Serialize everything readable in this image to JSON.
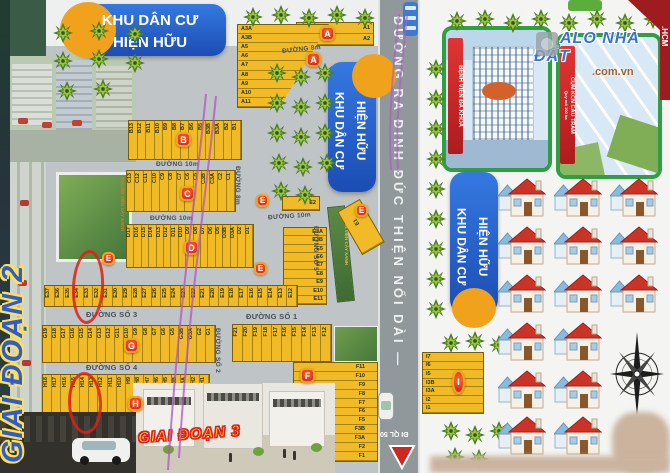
{
  "banners": {
    "residential": {
      "line1": "KHU DÂN CƯ",
      "line2": "HIỆN HỮU"
    },
    "phase2": "GIAI ĐOẠN 2",
    "phase3": "GIAI ĐOẠN 3"
  },
  "insets": {
    "hospital": {
      "label": "BỆNH VIỆN ĐA KHOA"
    },
    "industrial": {
      "label": "CỤM KCN CẦU TRÀM",
      "sub": "Quy mô 100 ha"
    },
    "park": {
      "label": "KHUÔN VIÊN CÂY XANH"
    },
    "greenway": {
      "label": "KHUÔN VIÊN CÂY XANH"
    }
  },
  "watermark": {
    "title": "ALO NHÀ ĐẤT",
    "domain": ".com.vn"
  },
  "corner_ribbon": ".HCM",
  "roads": {
    "main": "ĐƯỜNG RA ĐINH ĐỨC THIỆN NỐI DÀI —",
    "exit": "ĐI QL 50",
    "d8m_top": "ĐƯỜNG 8m",
    "d8m_side": "ĐƯỜNG 8m",
    "d10m_1": "ĐƯỜNG 10m",
    "d10m_2": "ĐƯỜNG 10m",
    "d10m_3": "ĐƯỜNG 10m",
    "so1": "ĐƯỜNG SỐ 1",
    "so2": "ĐƯỜNG SỐ 2",
    "so3": "ĐƯỜNG SỐ 3",
    "so4": "ĐƯỜNG SỐ 4",
    "so5": "ĐƯỜNG SỐ 5"
  },
  "blocks": {
    "a_row": {
      "badge": "A",
      "plots": [
        "A1",
        "A2"
      ]
    },
    "a_col": {
      "badge": "A",
      "plots": [
        "A3A",
        "A3B",
        "A5",
        "A6",
        "A7",
        "A8",
        "A9",
        "A10",
        "A11"
      ]
    },
    "b": {
      "badge": "B",
      "plots": [
        "B13",
        "B12",
        "B11",
        "B10",
        "B9",
        "B8",
        "B7",
        "B6",
        "B5",
        "B3B",
        "B3A",
        "B2",
        "B1"
      ]
    },
    "c": {
      "badge": "C",
      "plots": [
        "C13",
        "C12",
        "C11",
        "C10",
        "C9",
        "C8",
        "C7",
        "C6",
        "C5",
        "C3B",
        "C3A",
        "C2",
        "C1"
      ]
    },
    "d": {
      "badge": "D",
      "plots": [
        "D17",
        "D16",
        "D15",
        "D14",
        "D13",
        "D12",
        "D11",
        "D10",
        "D9",
        "D8",
        "D7",
        "D6",
        "D5",
        "D3B",
        "D3A",
        "D2",
        "D1"
      ]
    },
    "e_top": {
      "badge": "E",
      "plots": [
        "E2"
      ]
    },
    "e_col": {
      "plots": [
        "E3A",
        "E3B",
        "E5",
        "E6",
        "E7",
        "E8",
        "E9",
        "E10",
        "E11"
      ]
    },
    "e1": {
      "badge": "E",
      "plots": [
        "E1"
      ]
    },
    "e_row": {
      "badge": "E",
      "plots": [
        "E37",
        "E36",
        "E35",
        "E34",
        "E33",
        "E32",
        "E31",
        "E30",
        "E29",
        "E28",
        "E27",
        "E26",
        "E25",
        "E24",
        "E23",
        "E22",
        "E21",
        "E20",
        "E19",
        "E18",
        "E17",
        "E16",
        "E15",
        "E14",
        "E13",
        "E12"
      ]
    },
    "f_row": {
      "plots": [
        "F21",
        "F20",
        "F19",
        "F18",
        "F17",
        "F16",
        "F15",
        "F14",
        "F13",
        "F12"
      ]
    },
    "f_col": {
      "badge": "F",
      "plots": [
        "F11",
        "F10",
        "F9",
        "F8",
        "F7",
        "F6",
        "F5",
        "F3B",
        "F3A",
        "F2",
        "F1"
      ]
    },
    "g": {
      "badge": "G",
      "plots": [
        "G19",
        "G18",
        "G17",
        "G16",
        "G15",
        "G14",
        "G13",
        "G12",
        "G11",
        "G10",
        "G9",
        "G8",
        "G7",
        "G6",
        "G5",
        "G3B",
        "G3A",
        "G2",
        "G1"
      ]
    },
    "h": {
      "badge": "H",
      "plots": [
        "H18",
        "H17",
        "H16",
        "H15",
        "H14",
        "H13",
        "H12",
        "H11",
        "H10",
        "H9",
        "H8",
        "H7",
        "H6",
        "H5",
        "H3B",
        "H3A",
        "H2",
        "H1"
      ]
    },
    "i": {
      "badge": "I",
      "plots": [
        "I7",
        "I6",
        "I5",
        "I3B",
        "I3A",
        "I2",
        "I1"
      ]
    }
  }
}
